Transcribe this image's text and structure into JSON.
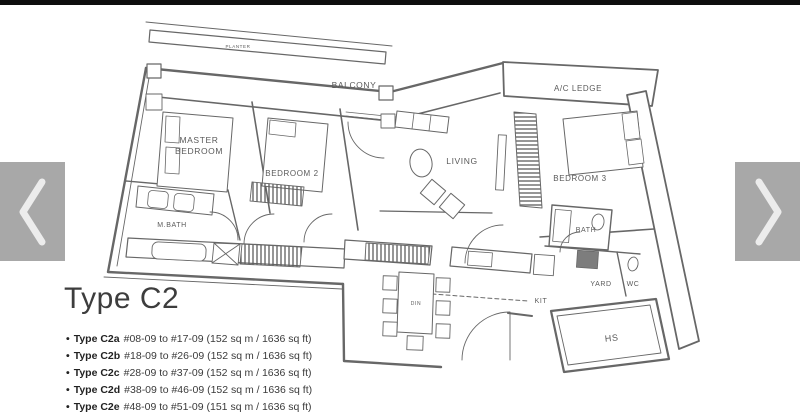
{
  "colors": {
    "topbar": "#0e0e0e",
    "nav_button_bg": "#a8a8a8",
    "nav_chevron": "#ececec",
    "plan_line": "#575757",
    "heading_text": "#3d3d3d",
    "body_text": "#333333"
  },
  "carousel": {
    "prev_icon": "chevron-left",
    "next_icon": "chevron-right"
  },
  "floorplan": {
    "labels": {
      "planter": "PLANTER",
      "balcony": "BALCONY",
      "ac_ledge": "A/C LEDGE",
      "master_line1": "MASTER",
      "master_line2": "BEDROOM",
      "bedroom2": "BEDROOM 2",
      "living": "LIVING",
      "bedroom3": "BEDROOM 3",
      "mbath": "M.BATH",
      "bath": "BATH",
      "kit": "KIT",
      "yard": "YARD",
      "wc": "WC",
      "hs": "HS",
      "din": "DIN"
    }
  },
  "unit_info": {
    "title": "Type C2",
    "bullet": "•",
    "units": [
      {
        "type": "Type C2a",
        "details": "#08-09 to #17-09 (152 sq m / 1636 sq ft)"
      },
      {
        "type": "Type C2b",
        "details": "#18-09 to #26-09 (152 sq m / 1636 sq ft)"
      },
      {
        "type": "Type C2c",
        "details": "#28-09 to #37-09 (152 sq m / 1636 sq ft)"
      },
      {
        "type": "Type C2d",
        "details": "#38-09 to #46-09 (152 sq m / 1636 sq ft)"
      },
      {
        "type": "Type C2e",
        "details": "#48-09 to #51-09 (151 sq m / 1636 sq ft)"
      }
    ]
  }
}
